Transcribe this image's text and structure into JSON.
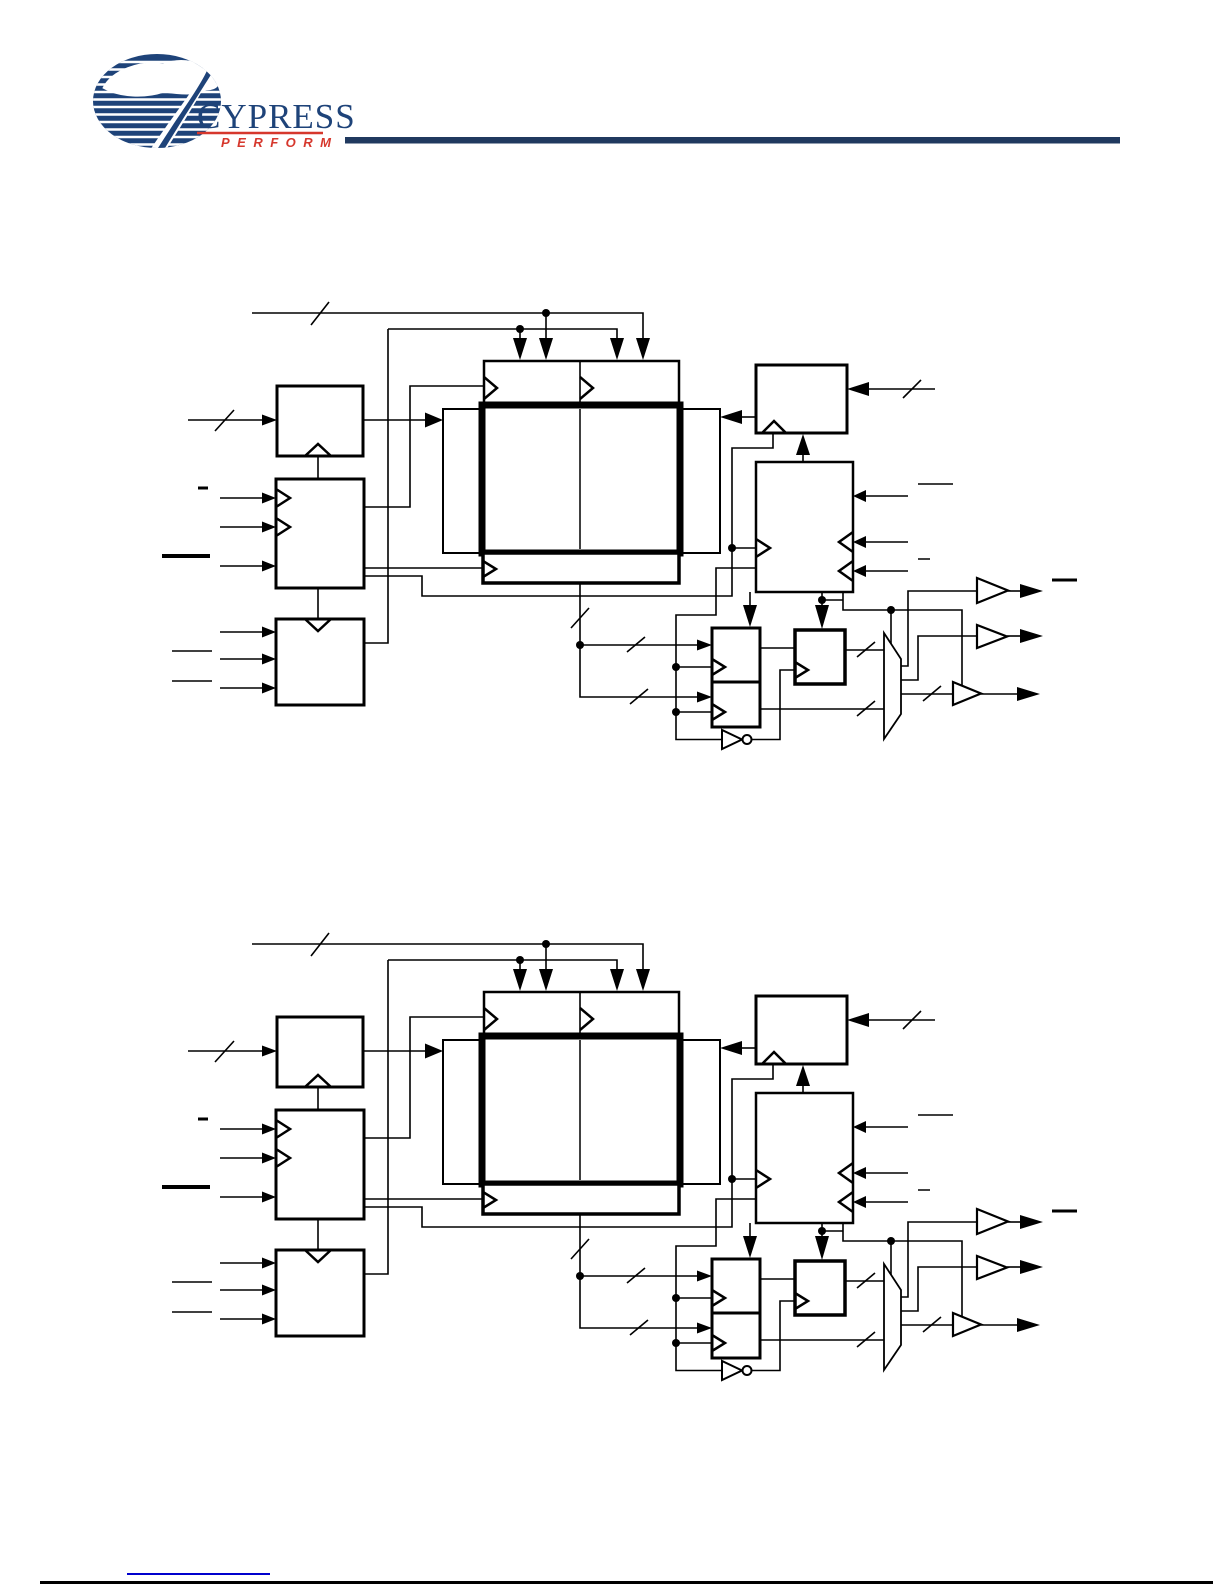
{
  "page": {
    "width": 1225,
    "height": 1585,
    "background": "#ffffff"
  },
  "logo": {
    "brand": "CYPRESS",
    "tagline": "PERFORM"
  },
  "colors": {
    "logo_navy": "#1e4379",
    "logo_red": "#d6372c",
    "header_rule_navy": "#20395f",
    "diagram_ink": "#000000",
    "footer_link_blue": "#0000cd",
    "footer_rule_black": "#000000"
  },
  "figures": {
    "top_diagram": {
      "name": "fifo-block-diagram-top",
      "text_labels_visible": ""
    },
    "bottom_diagram": {
      "name": "fifo-block-diagram-bottom",
      "text_labels_visible": ""
    }
  }
}
